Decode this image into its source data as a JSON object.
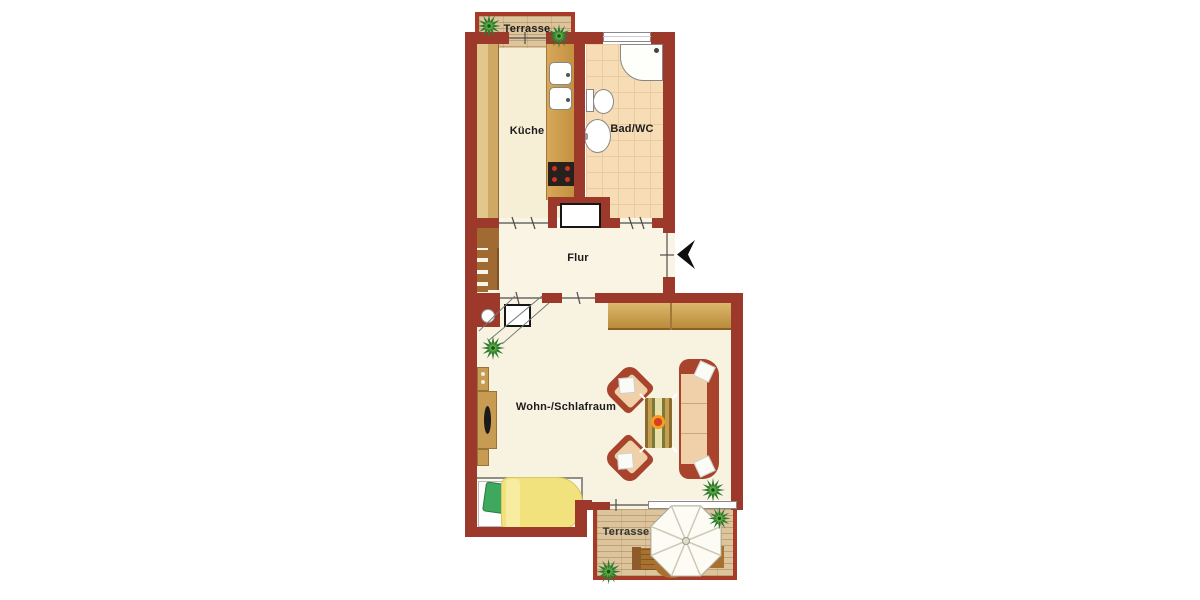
{
  "plan": {
    "rooms": {
      "terrace_top": {
        "label": "Terrasse"
      },
      "kitchen": {
        "label": "Küche"
      },
      "bathroom": {
        "label": "Bad/WC"
      },
      "hallway": {
        "label": "Flur"
      },
      "living_sleeping": {
        "label": "Wohn-/Schlafraum"
      },
      "terrace_bottom": {
        "label": "Terrasse"
      }
    },
    "colors": {
      "wall": "#9C392B",
      "terrace_border": "#A83A28",
      "floor_cream": "#F9F4E3",
      "floor_living": "#F8F2E1",
      "kitchen_floor": "#F6EFD5",
      "bath_tile": "#F6DDB6",
      "terrace_wood": "#DCC49C",
      "furniture_wood": "#C79C52",
      "sofa_frame": "#A8432C",
      "cushion": "#EFD0A8",
      "duvet_yellow": "#F2E27E",
      "pillow_green": "#3FA85F",
      "plant_green": "#2F7A33",
      "background": "#FFFFFF"
    },
    "fixtures": [
      "kitchen-sink",
      "stove",
      "kitchen-counter",
      "tall-cabinet",
      "shower",
      "toilet",
      "washbasin",
      "shaft",
      "stairs",
      "chimney-circle",
      "wardrobe",
      "sideboard-tv",
      "armchair",
      "armchair",
      "coffee-table-candle",
      "sofa",
      "bed",
      "parasol",
      "terrace-chairs",
      "terrace-table",
      "plants",
      "entrance-arrow",
      "sliding-door",
      "window"
    ]
  }
}
